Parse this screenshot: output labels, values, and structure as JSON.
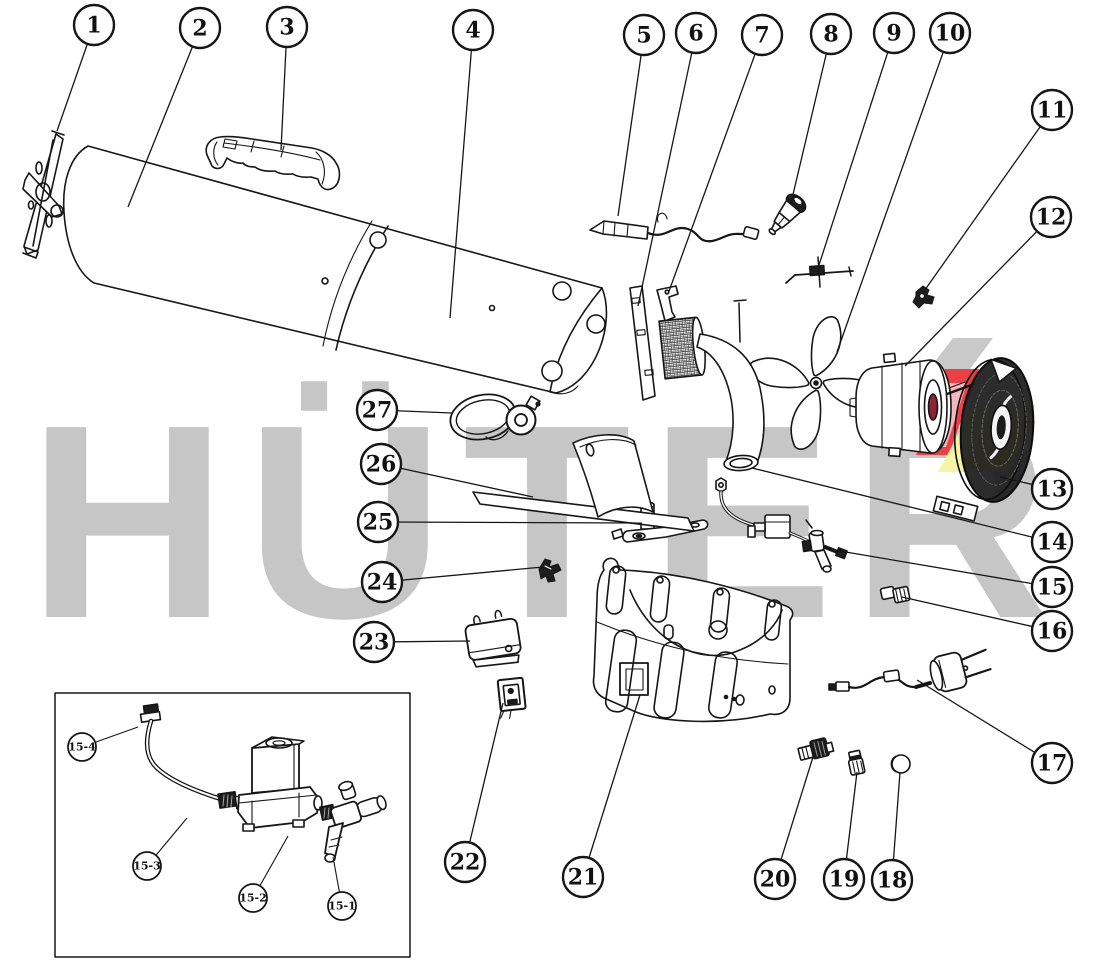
{
  "page": {
    "background": "#ffffff",
    "type": "exploded-parts-diagram"
  },
  "watermark": {
    "text": "HÜTER",
    "color": "#c6c6c6"
  },
  "logo": {
    "gray": "#c9c9c9",
    "red": "#ec4048",
    "pink": "#f4b7bb",
    "yellow": "#f8f4a6",
    "yellow_deep": "#eee584",
    "dark_red": "#8e2430"
  },
  "ink": "#161616",
  "callouts": {
    "radius": 20,
    "font_size": 22,
    "stroke_width": 2.4,
    "leader_width": 1.3,
    "items": [
      {
        "label": "1",
        "cx": 94,
        "cy": 25,
        "tx": 57,
        "ty": 131
      },
      {
        "label": "2",
        "cx": 200,
        "cy": 28,
        "tx": 128,
        "ty": 207
      },
      {
        "label": "3",
        "cx": 287,
        "cy": 27,
        "tx": 281,
        "ty": 150
      },
      {
        "label": "4",
        "cx": 473,
        "cy": 30,
        "tx": 450,
        "ty": 318
      },
      {
        "label": "5",
        "cx": 644,
        "cy": 35,
        "tx": 618,
        "ty": 216
      },
      {
        "label": "6",
        "cx": 696,
        "cy": 33,
        "tx": 638,
        "ty": 306
      },
      {
        "label": "7",
        "cx": 762,
        "cy": 35,
        "tx": 668,
        "ty": 294
      },
      {
        "label": "8",
        "cx": 831,
        "cy": 34,
        "tx": 791,
        "ty": 203
      },
      {
        "label": "9",
        "cx": 894,
        "cy": 33,
        "tx": 819,
        "ty": 265
      },
      {
        "label": "10",
        "cx": 950,
        "cy": 33,
        "tx": 837,
        "ty": 352
      },
      {
        "label": "11",
        "cx": 1052,
        "cy": 110,
        "tx": 922,
        "ty": 294
      },
      {
        "label": "12",
        "cx": 1051,
        "cy": 217,
        "tx": 905,
        "ty": 366
      },
      {
        "label": "13",
        "cx": 1052,
        "cy": 489,
        "tx": 1000,
        "ty": 477
      },
      {
        "label": "14",
        "cx": 1052,
        "cy": 542,
        "tx": 752,
        "ty": 468
      },
      {
        "label": "15",
        "cx": 1052,
        "cy": 587,
        "tx": 828,
        "ty": 549
      },
      {
        "label": "16",
        "cx": 1052,
        "cy": 631,
        "tx": 902,
        "ty": 597
      },
      {
        "label": "17",
        "cx": 1052,
        "cy": 763,
        "tx": 917,
        "ty": 680
      },
      {
        "label": "18",
        "cx": 892,
        "cy": 880,
        "tx": 900,
        "ty": 772
      },
      {
        "label": "19",
        "cx": 844,
        "cy": 879,
        "tx": 857,
        "ty": 772
      },
      {
        "label": "20",
        "cx": 775,
        "cy": 879,
        "tx": 813,
        "ty": 757
      },
      {
        "label": "21",
        "cx": 583,
        "cy": 877,
        "tx": 640,
        "ty": 695
      },
      {
        "label": "22",
        "cx": 465,
        "cy": 862,
        "tx": 503,
        "ty": 703
      },
      {
        "label": "23",
        "cx": 374,
        "cy": 642,
        "tx": 470,
        "ty": 641
      },
      {
        "label": "24",
        "cx": 382,
        "cy": 582,
        "tx": 543,
        "ty": 567
      },
      {
        "label": "25",
        "cx": 378,
        "cy": 522,
        "tx": 642,
        "ty": 523
      },
      {
        "label": "26",
        "cx": 381,
        "cy": 464,
        "tx": 533,
        "ty": 497
      },
      {
        "label": "27",
        "cx": 377,
        "cy": 410,
        "tx": 452,
        "ty": 413
      }
    ]
  },
  "inset_callouts": {
    "radius": 14,
    "font_size": 11,
    "stroke_width": 1.8,
    "leader_width": 1.1,
    "items": [
      {
        "label": "15-4",
        "cx": 82,
        "cy": 747,
        "tx": 138,
        "ty": 727
      },
      {
        "label": "15-3",
        "cx": 147,
        "cy": 866,
        "tx": 187,
        "ty": 818
      },
      {
        "label": "15-2",
        "cx": 253,
        "cy": 898,
        "tx": 288,
        "ty": 836
      },
      {
        "label": "15-1",
        "cx": 342,
        "cy": 906,
        "tx": 333,
        "ty": 857
      }
    ]
  }
}
